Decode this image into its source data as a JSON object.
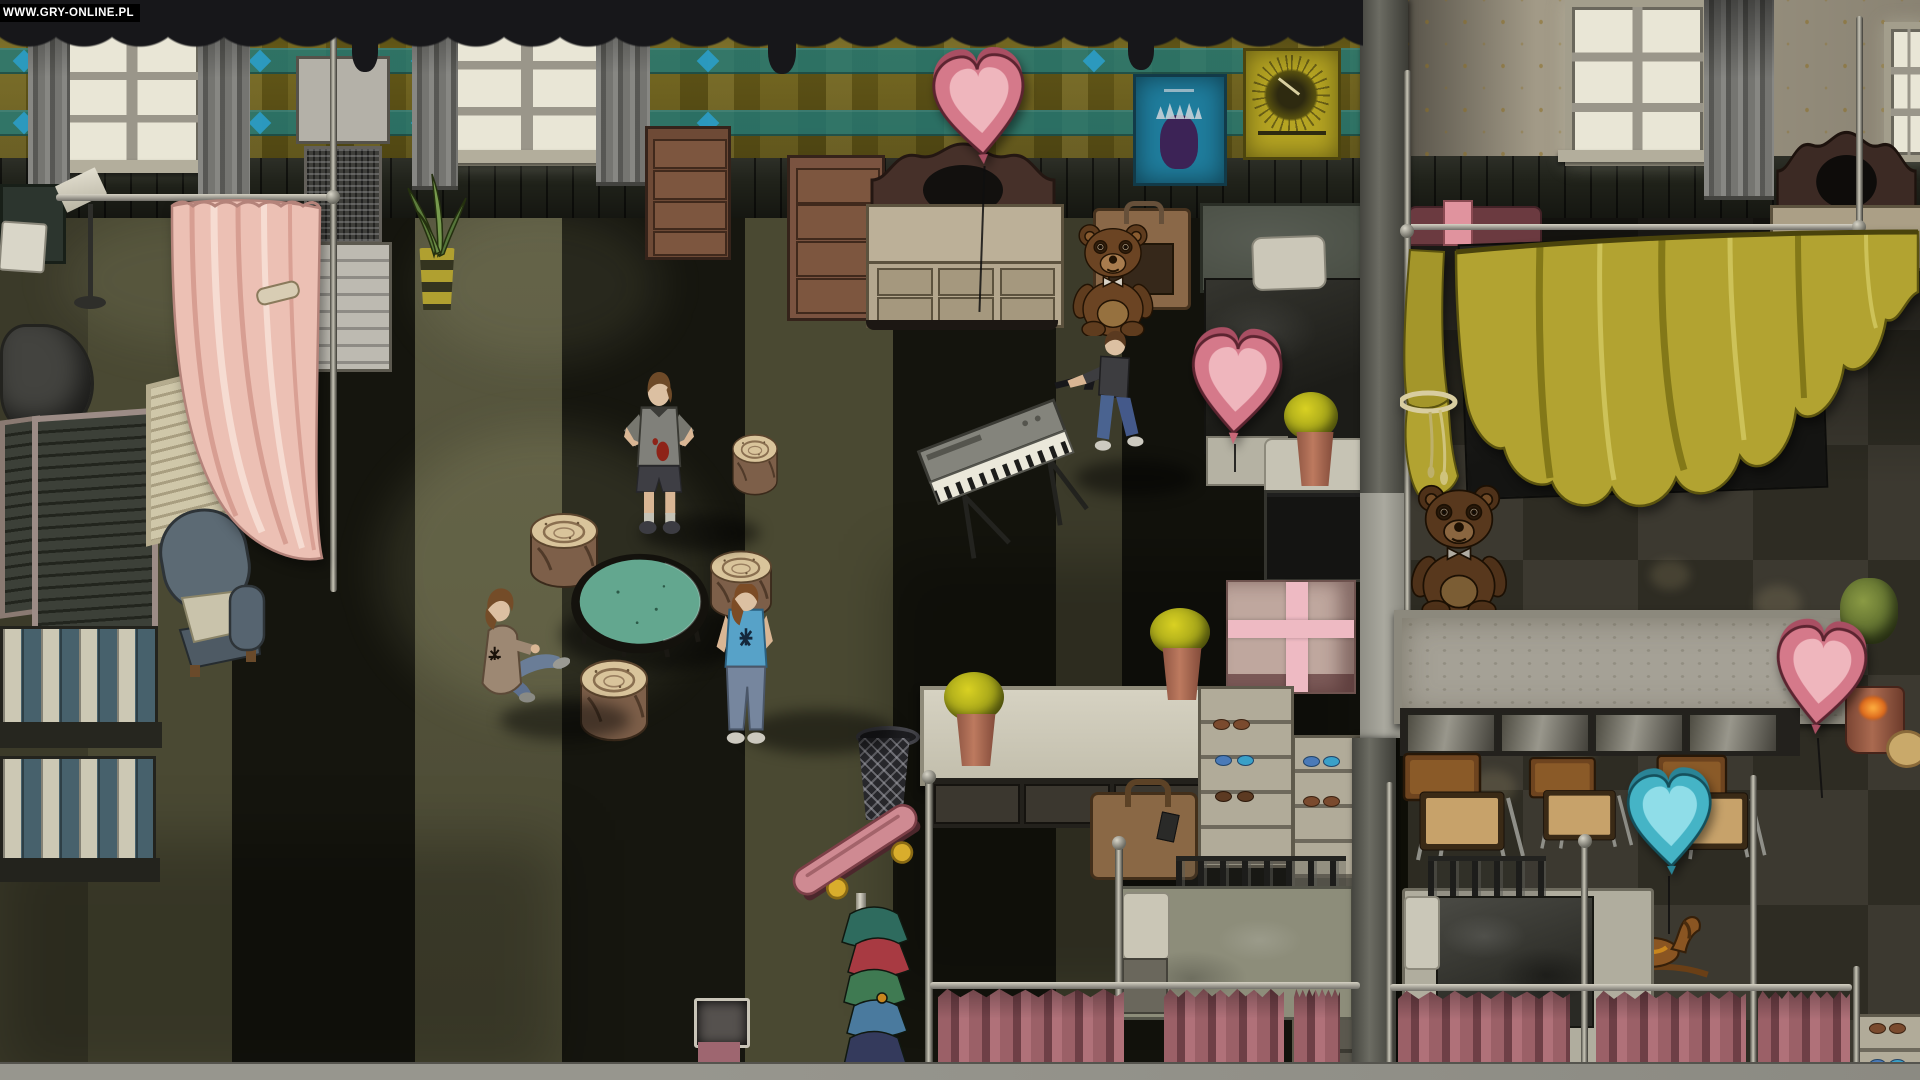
{
  "watermark": {
    "text": "WWW.GRY-ONLINE.PL"
  },
  "scene": {
    "setting": "top-down dormitory room at night, two rooms divided by a pillar wall",
    "rooms": [
      "common-dormitory",
      "canopy-bedroom"
    ],
    "characters": [
      {
        "name": "kid-hands-on-hips",
        "desc": "child in gray blood-stained t-shirt and dark shorts standing with hands on hips"
      },
      {
        "name": "kid-sitting",
        "desc": "child in brown jacket with black scribble mark sitting on the floor kicking"
      },
      {
        "name": "kid-blue-shirt",
        "desc": "child in blue t-shirt with black star emblem standing at the table"
      },
      {
        "name": "kid-with-rifle",
        "desc": "child in dark t-shirt and jeans walking while holding a rifle"
      }
    ],
    "props": [
      "pink-heart-balloon x3",
      "blue-heart-balloon x1",
      "giant-teddy-bear x2",
      "electronic-keyboard-piano",
      "tree-stump-stool x4",
      "round-teal-table",
      "pink-drape-curtain",
      "yellow-canopy",
      "metal-frame-beds",
      "bunk-bed",
      "mauve-privacy-curtains",
      "pink-skateboard",
      "wire-trash-basket",
      "clothes-rack",
      "gift-box-with-pink-ribbon",
      "leather-briefcase",
      "shoe-shelves",
      "potted-yellow-flowers x4",
      "aloe-plant",
      "rocking-horse",
      "folding-screen",
      "armchair",
      "striped-mattresses x2",
      "chest-of-drawers x2",
      "cream-dresser x2",
      "wall-posters x2",
      "air-conditioner-unit",
      "floor-lamp",
      "school-desks x3",
      "long-table-with-bench",
      "candle-pot",
      "bush-pot",
      "suitcase",
      "dark-crate"
    ]
  },
  "palette": {
    "heart_pink": "#d5798a",
    "heart_pink_light": "#efb6bd",
    "heart_pink_dark": "#a94f63",
    "heart_blue": "#45b4c6",
    "heart_blue_light": "#8fdde8",
    "heart_blue_dark": "#2a8496",
    "canopy_yellow": "#b2a331",
    "canopy_yellow_dark": "#837818",
    "canopy_yellow_light": "#cdc258",
    "curtain_pink": "#ecc0b4",
    "curtain_mauve": "#9b6067",
    "carpet_olive": "#4c4b32",
    "carpet_dark": "#15150e",
    "floor_right": "#363329",
    "wall_plaid_base": "#7e6f1d",
    "wall_plaid_teal": "#207a7a",
    "wall_diamond_blue": "#2ba0ce",
    "wall_cream": "#a29a87",
    "wall_gold": "#96782a",
    "table_teal": "#63a78f",
    "stump_top": "#d9c49b",
    "stump_side": "#7d5f49",
    "teddy_brown": "#6b4423",
    "skateboard_pink": "#cf8a92",
    "wheel_yellow": "#d9ad2c",
    "valance_dark": "#17171a",
    "wainscot": "#20221a",
    "concrete": "#8f8e86",
    "gift_ribbon": "#eebac3",
    "jeans_blue": "#5e7190",
    "shirt_blue": "#57a2c8"
  }
}
